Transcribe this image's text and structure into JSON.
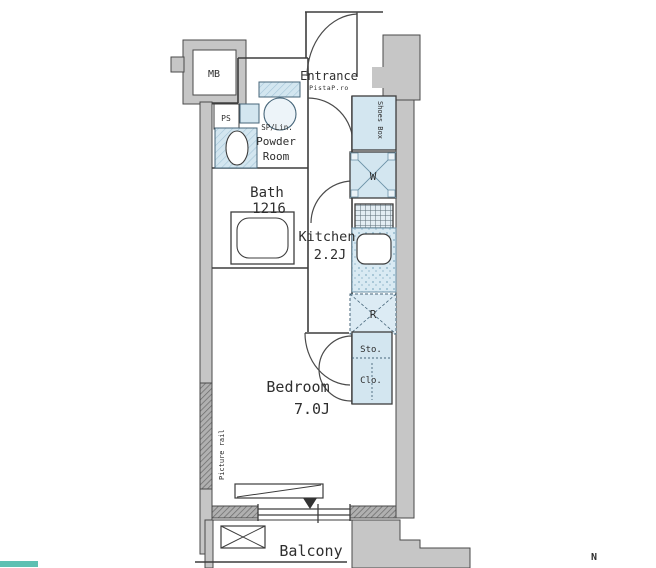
{
  "rooms": {
    "entrance": {
      "label": "Entrance",
      "note": "PistaP.ro"
    },
    "powder_room": {
      "note": "SP/Lin.",
      "label_line1": "Powder",
      "label_line2": "Room"
    },
    "bath": {
      "label": "Bath",
      "size": "1216"
    },
    "kitchen": {
      "label": "Kitchen",
      "size": "2.2J"
    },
    "bedroom": {
      "label": "Bedroom",
      "size": "7.0J"
    },
    "balcony": {
      "label": "Balcony"
    }
  },
  "fixtures": {
    "meter_box": "MB",
    "pipe_space": "PS",
    "shoes_box": "Shoes Box",
    "washing_machine": "W",
    "refrigerator": "R",
    "storage": "Sto.",
    "closet": "Clo.",
    "picture_rail": "Picture rail"
  },
  "compass": {
    "north": "N"
  },
  "colors": {
    "wall_gray": "#c6c6c6",
    "fixture_blue": "#d3e6f0",
    "line": "#3d3d3d",
    "teal_fragment": "#5ec0b2"
  }
}
